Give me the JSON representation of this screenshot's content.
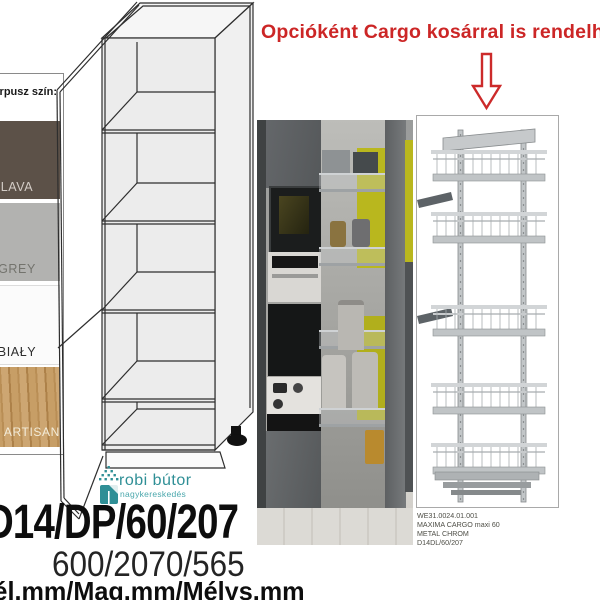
{
  "annotation": {
    "text": "Opcióként Cargo kosárral is rendelhető"
  },
  "swatch_panel": {
    "header": "Korpusz szín:",
    "items": [
      {
        "label": "LAVA",
        "color": "#5c5148"
      },
      {
        "label": "GREY",
        "color": "#b2b2b0"
      },
      {
        "label": "BIAŁY",
        "color": "#fbfbfb"
      },
      {
        "label": "DĄB ARTISAN",
        "color": "#c49a62"
      }
    ]
  },
  "logo": {
    "name": "robi bútor",
    "subtitle": "nagykereskedés",
    "color": "#2f8f96"
  },
  "cargo_product": {
    "lines": [
      "WE31.0024.01.001",
      "MAXIMA CARGO maxi 60",
      "METAL CHROM",
      "D14DL/60/207"
    ]
  },
  "footer": {
    "model_code": "D14/DP/60/207",
    "dimensions": "600/2070/565",
    "dimension_labels": "Szél.mm/Mag.mm/Mélys.mm"
  },
  "colors": {
    "accent_red": "#cc2626",
    "logo_teal": "#2f8f96",
    "kitchen_yellow": "#b9b71e",
    "drawing_line": "#2e2e2e"
  }
}
